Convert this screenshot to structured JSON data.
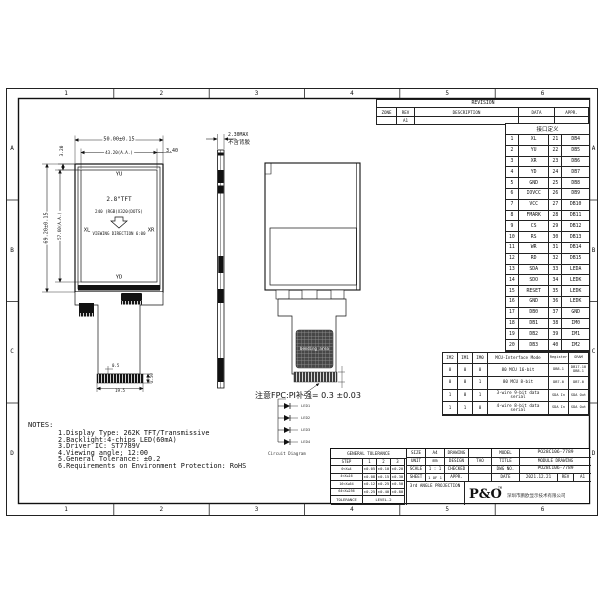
{
  "sheet": {
    "zone_letters": [
      "A",
      "B",
      "C",
      "D"
    ],
    "zone_numbers": [
      "1",
      "2",
      "3",
      "4",
      "5",
      "6"
    ]
  },
  "revision": {
    "title": "REVISION",
    "columns": [
      "ZONE",
      "REV",
      "DESCRIPTION",
      "DATA",
      "APPR."
    ],
    "row": {
      "zone": "",
      "rev": "A1",
      "description": "",
      "data": "",
      "appr": ""
    }
  },
  "pin_table": {
    "header": "接口定义",
    "pins": [
      {
        "no": "1",
        "name": "XL"
      },
      {
        "no": "2",
        "name": "YU"
      },
      {
        "no": "3",
        "name": "XR"
      },
      {
        "no": "4",
        "name": "YD"
      },
      {
        "no": "5",
        "name": "GND"
      },
      {
        "no": "6",
        "name": "IOVCC"
      },
      {
        "no": "7",
        "name": "VCC"
      },
      {
        "no": "8",
        "name": "FMARK"
      },
      {
        "no": "9",
        "name": "CS"
      },
      {
        "no": "10",
        "name": "RS"
      },
      {
        "no": "11",
        "name": "WR"
      },
      {
        "no": "12",
        "name": "RD"
      },
      {
        "no": "13",
        "name": "SDA"
      },
      {
        "no": "14",
        "name": "SDO"
      },
      {
        "no": "15",
        "name": "RESET"
      },
      {
        "no": "16",
        "name": "GND"
      },
      {
        "no": "17",
        "name": "DB0"
      },
      {
        "no": "18",
        "name": "DB1"
      },
      {
        "no": "19",
        "name": "DB2"
      },
      {
        "no": "20",
        "name": "DB3"
      },
      {
        "no": "21",
        "name": "DB4"
      },
      {
        "no": "22",
        "name": "DB5"
      },
      {
        "no": "23",
        "name": "DB6"
      },
      {
        "no": "24",
        "name": "DB7"
      },
      {
        "no": "25",
        "name": "DB8"
      },
      {
        "no": "26",
        "name": "DB9"
      },
      {
        "no": "27",
        "name": "DB10"
      },
      {
        "no": "28",
        "name": "DB11"
      },
      {
        "no": "29",
        "name": "DB12"
      },
      {
        "no": "30",
        "name": "DB13"
      },
      {
        "no": "31",
        "name": "DB14"
      },
      {
        "no": "32",
        "name": "DB15"
      },
      {
        "no": "33",
        "name": "LEDA"
      },
      {
        "no": "34",
        "name": "LEDK"
      },
      {
        "no": "35",
        "name": "LEDK"
      },
      {
        "no": "36",
        "name": "LEDK"
      },
      {
        "no": "37",
        "name": "GND"
      },
      {
        "no": "38",
        "name": "IM0"
      },
      {
        "no": "39",
        "name": "IM1"
      },
      {
        "no": "40",
        "name": "IM2"
      }
    ]
  },
  "interface_table": {
    "columns": [
      "IM2",
      "IM1",
      "IM0",
      "MCU-Interface Mode",
      "Register",
      "GRAM"
    ],
    "rows": [
      [
        "0",
        "0",
        "0",
        "80 MCU 16-bit",
        "DB8-1",
        "DB17-10 DB8-1"
      ],
      [
        "0",
        "0",
        "1",
        "80 MCU 8-bit",
        "DB7-0",
        "DB7-0"
      ],
      [
        "1",
        "0",
        "1",
        "3-wire 9-bit data serial",
        "SDA In",
        "SDA Out"
      ],
      [
        "1",
        "1",
        "0",
        "4-wire 8-bit data serial",
        "SDA In",
        "SDA Out"
      ]
    ]
  },
  "front_view": {
    "dim_width": "50.00±0.15",
    "dim_width_aa": "43.20(A.A.)",
    "dim_right": "3.40",
    "dim_top_left": "3.20",
    "dim_height": "69.20±0.15",
    "dim_height_aa": "57.60(A.A.)",
    "label_top": "YU",
    "label_bottom": "YD",
    "label_left": "XL",
    "label_right": "XR",
    "line1": "2.8\"TFT",
    "line2": "240 (RGB)X320(DOTS)",
    "line3": "VIEWING DIRECTION 6:00",
    "fpc_dim_pitch": "0.5",
    "fpc_dim_width": "19.5",
    "fpc_dim_h": "2.50"
  },
  "side_view": {
    "dim": "2.30MAX",
    "note": "不含背胶"
  },
  "back_view": {
    "bending_label": "bending area",
    "note": "注意FPC:PI补强= 0.3 ±0.03"
  },
  "circuit": {
    "leds": [
      "LED1",
      "LED2",
      "LED3",
      "LED4"
    ],
    "caption": "Circuit Diagram"
  },
  "notes": {
    "title": "NOTES:",
    "items": [
      "1.Display Type: 262K TFT/Transmissive",
      "2.Backlight:4-chips LED(60mA)",
      "3.Driver IC: ST7789V",
      "4.Viewing angle;  12:00",
      "5.General Tolerance: ±0.2",
      "6.Requirements on Environment Protection: RoHS"
    ]
  },
  "title_block": {
    "tolerance": {
      "header": "GENERAL TOLERANCE",
      "col_headers": [
        "STEP",
        "1",
        "2",
        "3"
      ],
      "rows": [
        [
          "0<X≤4",
          "±0.05",
          "±0.10",
          "±0.20"
        ],
        [
          "4<X≤16",
          "±0.08",
          "±0.15",
          "±0.30"
        ],
        [
          "16<X≤64",
          "±0.12",
          "±0.25",
          "±0.50"
        ],
        [
          "64<X≤256",
          "±0.25",
          "±0.40",
          "±0.80"
        ]
      ],
      "footer_label": "TOLERANCE",
      "footer_value": "LEVEL-2"
    },
    "size_label": "SIZE",
    "size": "A4",
    "unit_label": "UNIT",
    "unit": "mm",
    "scale_label": "SCALE",
    "scale": "1 : 1",
    "sheet_label": "SHEET",
    "sheet": "1 OF 1",
    "projection": "3rd ANGLE PROJECTION",
    "drawing_label": "DRAWING",
    "drawing": "",
    "design_label": "DESIGN",
    "design": "TAO",
    "checked_label": "CHECKED",
    "checked": "",
    "appr_label": "APPR.",
    "appr": "",
    "model_label": "MODEL",
    "model": "PO28C106-7789",
    "title_label": "TITLE",
    "title": "MODULE DRAWING",
    "dwg_label": "DWG NO.",
    "dwg_no": "PO28C106-7789",
    "date_label": "DATE",
    "date": "2021.12.21",
    "rev_label": "REV",
    "rev": "A1",
    "logo": "P&O",
    "logo_sup": "TM",
    "company": "深圳市鹏欧显示技术有限公司"
  }
}
